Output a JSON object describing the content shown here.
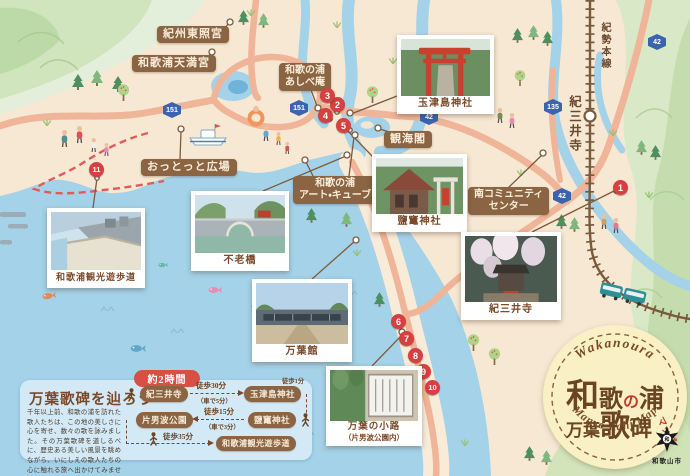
{
  "colors": {
    "label_bg": "#8a6443",
    "marker_red": "#d64040",
    "sea": "#a4d2e9",
    "road": "#f0b498",
    "panel_bg": "#d3eaf6",
    "badge_cream": "#f9f0c5",
    "text_brown": "#7a4a2a",
    "route_sign_blue": "#3c63ae",
    "trail_red": "#e05c5c"
  },
  "labels": {
    "kishu_toshogu": "紀州東照宮",
    "wakaura_tenmangu": "和歌浦天満宮",
    "ashibean_l1": "和歌の浦",
    "ashibean_l2": "あしべ庵",
    "ottotto": "おっとっと広場",
    "kankaikaku": "観海閣",
    "artcube_l1": "和歌の浦",
    "artcube_l2": "アート・キューブ",
    "minami_l1": "南コミュニティ",
    "minami_l2": "センター",
    "kisei_line": "紀勢本線",
    "kimiidera_station": "紀三井寺"
  },
  "photos": {
    "yuhodo": {
      "caption": "和歌浦観光遊歩道"
    },
    "furobashi": {
      "caption": "不老橋"
    },
    "manyokan": {
      "caption": "万葉館"
    },
    "tamatsushima": {
      "caption": "玉津島神社"
    },
    "shiogama": {
      "caption": "鹽竃神社"
    },
    "kimiidera": {
      "caption": "紀三井寺"
    },
    "komichi": {
      "caption": "万葉の小路",
      "subcaption": "（片男波公園内）"
    }
  },
  "route_signs": {
    "s151a": "151",
    "s151b": "151",
    "s42a": "42",
    "s42b": "42",
    "s42c": "42",
    "s135": "135"
  },
  "markers": {
    "m1": "1",
    "m2": "2",
    "m3": "3",
    "m4": "4",
    "m5": "5",
    "m6": "6",
    "m7": "7",
    "m8": "8",
    "m9": "9",
    "m10": "10",
    "m11": "11"
  },
  "panel": {
    "duration": "約2時間",
    "title": "万葉歌碑を辿ろう",
    "body": "千年以上前、和歌の浦を訪れた歌人たちは、この地の美しさに心を寄せ、数々の歌を詠みました。その万葉歌碑を道しるべに、歴史ある美しい風景を眺めながら、いにしえの歌人たちの心に触れる旅へ出かけてみませんか。",
    "stops": {
      "kimiidera": "紀三井寺",
      "tamatsushima": "玉津島神社",
      "shiogama": "鹽竃神社",
      "kataonami": "片男波公園",
      "yuhodo": "和歌浦観光遊歩道"
    },
    "legs": {
      "walk30": "徒歩30分",
      "car5": "（車で5分）",
      "walk1": "徒歩1分",
      "walk15": "徒歩15分",
      "car3": "（車で3分）",
      "walk35": "徒歩35分"
    }
  },
  "badge": {
    "arc_top": "Wakanoura",
    "t1": "和",
    "t2": "歌",
    "t3": "の",
    "t4": "浦",
    "t5": "万葉",
    "t6": "歌",
    "t7": "碑",
    "t8": "マップ",
    "arc_bottom": "Manyo Kahi Map"
  },
  "city": {
    "emblem_char": "和",
    "name": "和歌山市"
  }
}
